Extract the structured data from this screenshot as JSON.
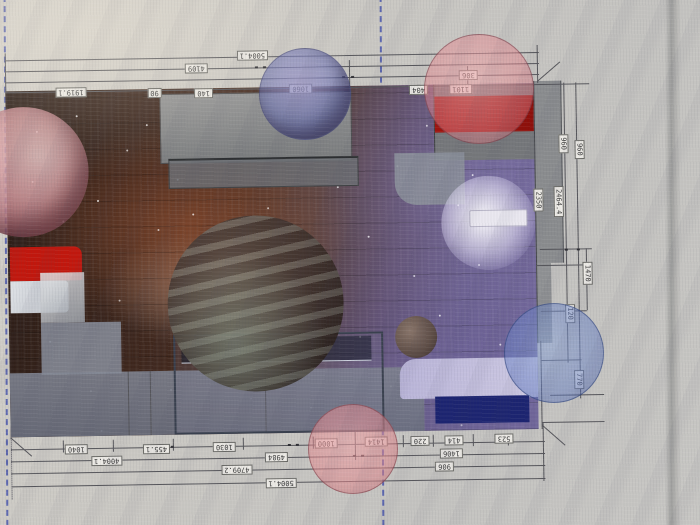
{
  "colors": {
    "screen_bg": "#cac8c3",
    "guide_blue": "#3746a8",
    "dim_line": "#55555a",
    "label_bg": "#eceae5",
    "floor_wood": "#43291e",
    "nebula_purple": "#6f6496",
    "wall_gray": "#8a8c8e",
    "red_block_top": "#a1120c",
    "red_block_left": "#c1170d",
    "navy_block": "#1c2470",
    "circle_pink": "rgba(224,130,138,0.55)",
    "circle_blue": "rgba(104,112,180,0.55)"
  },
  "note": "dimension text appears rotated 180 degrees (plan viewed upside-down)",
  "dims": {
    "top": [
      "5004.1",
      "4109",
      "1919.1",
      "90",
      "140",
      "1060",
      "404",
      "306",
      "1101"
    ],
    "right": [
      "960",
      "960",
      "2350",
      "2464.4",
      "1470",
      "120",
      "770"
    ],
    "bottom": [
      "1040",
      "455.1",
      "1030",
      "1000",
      "1414",
      "220",
      "414",
      "523",
      "4004.1",
      "4984",
      "1406",
      "4709.2",
      "906",
      "5004.1"
    ]
  }
}
